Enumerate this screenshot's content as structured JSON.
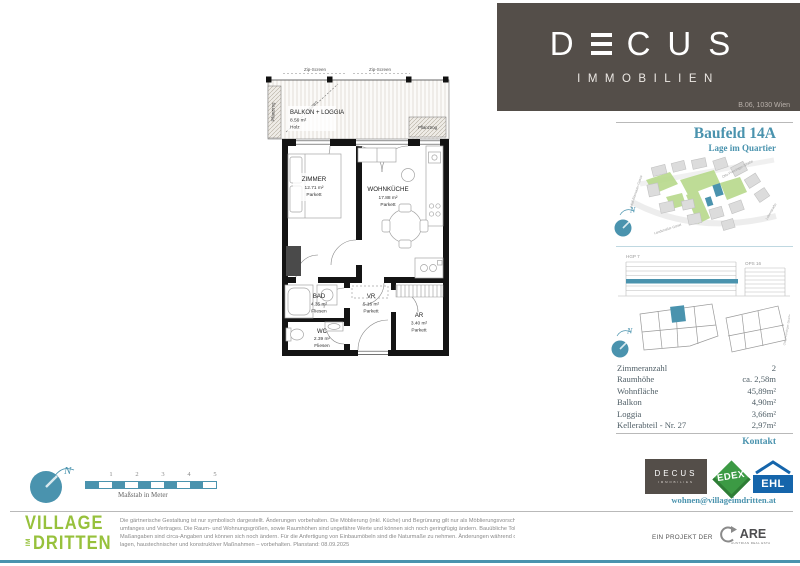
{
  "header": {
    "brand_d": "D",
    "brand_cus": "CUS",
    "brand_sub": "IMMOBILIEN",
    "address": "B.06, 1030 Wien"
  },
  "panel": {
    "title": "Baufeld 14A",
    "subtitle": "Lage im Quartier",
    "compass_label": "N",
    "map_streets": {
      "top": "Otto-Preminger-Straße",
      "left": "Adolf-Blamauer-Gasse",
      "bottom": "Landstraßer Gürtel",
      "right": "Leberstraße"
    },
    "sections": {
      "left": "HGP 7",
      "right": "OPS 16"
    },
    "outline_street": "Otto-Preminger-Straße",
    "details": [
      {
        "label": "Zimmeranzahl",
        "value": "2"
      },
      {
        "label": "Raumhöhe",
        "value": "ca. 2,58m"
      },
      {
        "label": "Wohnfläche",
        "value": "45,89m²"
      },
      {
        "label": "Balkon",
        "value": "4,90m²"
      },
      {
        "label": "Loggia",
        "value": "3,66m²"
      },
      {
        "label": "Kellerabteil - Nr. 27",
        "value": "2,97m²"
      }
    ],
    "contact_label": "Kontakt",
    "email": "wohnen@villageimdritten.at",
    "logos": {
      "decus": "DECUS",
      "decus_sub": "IMMOBILIEN",
      "edex": "EDEX",
      "ehl": "EHL"
    }
  },
  "floorplan": {
    "balcony": {
      "zip_screen": "Zip-Screen",
      "screen_diag": "Screen",
      "name": "BALKON + LOGGIA",
      "area": "8.56 m²",
      "floor": "Holz",
      "pflanztrog": "Pflanztrog"
    },
    "rooms": [
      {
        "name": "ZIMMER",
        "area": "12.71 m²",
        "floor": "Parkett"
      },
      {
        "name": "WOHNKÜCHE",
        "area": "17.88 m²",
        "floor": "Parkett"
      },
      {
        "name": "BAD",
        "area": "4.35 m²",
        "floor": "Fliesen"
      },
      {
        "name": "VR",
        "area": "5.16 m²",
        "floor": "Parkett"
      },
      {
        "name": "WC",
        "area": "2.39 m²",
        "floor": "Fliesen"
      },
      {
        "name": "AR",
        "area": "3.40 m²",
        "floor": "Parkett"
      }
    ]
  },
  "footer": {
    "scale_label": "Maßstab in Meter",
    "scale_ticks": [
      "1",
      "2",
      "3",
      "4",
      "5"
    ],
    "compass_label": "N",
    "village": {
      "line1": "VILLAGE",
      "im": "IM",
      "line2": "DRITTEN"
    },
    "disclaimer": [
      "Die gärtnerische Gestaltung ist nur symbolisch dargestellt. Änderungen vorbehalten. Die Möblierung (inkl. Küche) und Begrünung gilt nur als Möblierungsvorschlag und ist daher nicht Bestandteil des Liefer-",
      "umfanges und Vertrages. Die Raum- und Wohnungsgrößen, sowie Raumhöhen sind ungefähre Werte und können sich noch geringfügig ändern. Bauübliche Toleranzen sind zulässig. Sämtliche Maße und",
      "Maßangaben sind circa-Angaben und können sich noch ändern. Für die Anfertigung von Einbaumöbeln sind die Naturmaße zu nehmen. Änderungen während der Bauausführung – infolge Behördenauf-",
      "lagen, haustechnischer und konstruktiver Maßnahmen – vorbehalten. Planstand: 08.09.2025"
    ],
    "project": {
      "prefix": "EIN PROJEKT DER",
      "name": "ARE",
      "sub": "AUSTRIAN REAL ESTATE"
    }
  },
  "colors": {
    "accent_teal": "#4A93AE",
    "brand_brown": "#544E49",
    "village_green": "#97C13C",
    "edex_green": "#3C9A44",
    "ehl_blue": "#1565AB"
  }
}
